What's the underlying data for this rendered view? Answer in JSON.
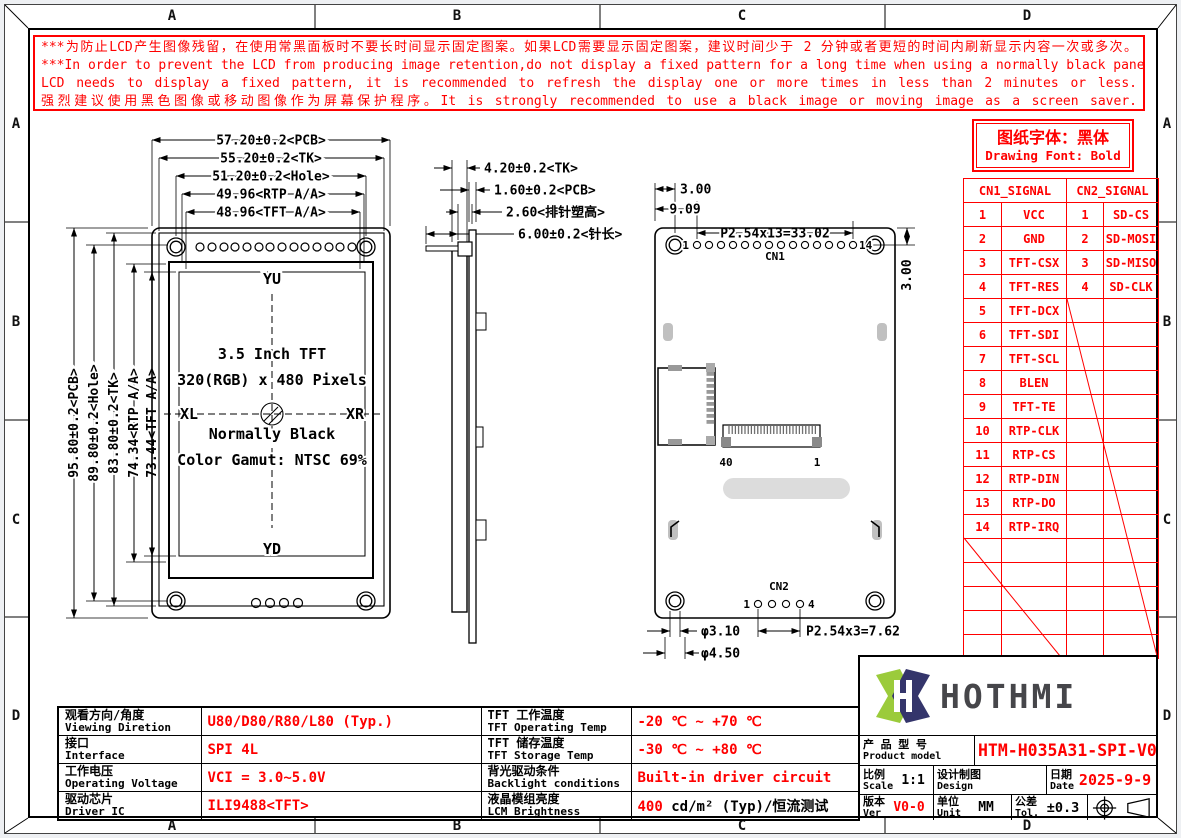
{
  "frame": {
    "cols": [
      "A",
      "B",
      "C",
      "D"
    ],
    "rows": [
      "A",
      "B",
      "C",
      "D"
    ]
  },
  "colors": {
    "red": "#FF0000",
    "line": "#000000",
    "logo_green": "#9BCB3B",
    "logo_navy": "#34356B"
  },
  "warning": {
    "lines": [
      "***为防止LCD产生图像残留，在使用常黑面板时不要长时间显示固定图案。如果LCD需要显示固定图案，建议时间少于 2 分钟或者更短的时间内刷新显示内容一次或多次。",
      "***In order to prevent the LCD from producing image retention,do not display a fixed pattern for a long time when using a normally black panel.If the",
      "LCD needs to display a fixed pattern,  it is recommended to refresh the display one or more times in less than 2 minutes or less.",
      "强烈建议使用黑色图像或移动图像作为屏幕保护程序。It is strongly recommended to use a black image or moving image as a screen saver."
    ]
  },
  "font_note": {
    "cn": "图纸字体：黑体",
    "en": "Drawing Font: Bold"
  },
  "signal_table": {
    "h1": "CN1_SIGNAL",
    "h2": "CN2_SIGNAL",
    "rows": [
      {
        "p1": "1",
        "s1": "VCC",
        "p2": "1",
        "s2": "SD-CS"
      },
      {
        "p1": "2",
        "s1": "GND",
        "p2": "2",
        "s2": "SD-MOSI"
      },
      {
        "p1": "3",
        "s1": "TFT-CSX",
        "p2": "3",
        "s2": "SD-MISO"
      },
      {
        "p1": "4",
        "s1": "TFT-RES",
        "p2": "4",
        "s2": "SD-CLK"
      },
      {
        "p1": "5",
        "s1": "TFT-DCX",
        "p2": "",
        "s2": ""
      },
      {
        "p1": "6",
        "s1": "TFT-SDI",
        "p2": "",
        "s2": ""
      },
      {
        "p1": "7",
        "s1": "TFT-SCL",
        "p2": "",
        "s2": ""
      },
      {
        "p1": "8",
        "s1": "BLEN",
        "p2": "",
        "s2": ""
      },
      {
        "p1": "9",
        "s1": "TFT-TE",
        "p2": "",
        "s2": ""
      },
      {
        "p1": "10",
        "s1": "RTP-CLK",
        "p2": "",
        "s2": ""
      },
      {
        "p1": "11",
        "s1": "RTP-CS",
        "p2": "",
        "s2": ""
      },
      {
        "p1": "12",
        "s1": "RTP-DIN",
        "p2": "",
        "s2": ""
      },
      {
        "p1": "13",
        "s1": "RTP-DO",
        "p2": "",
        "s2": ""
      },
      {
        "p1": "14",
        "s1": "RTP-IRQ",
        "p2": "",
        "s2": ""
      }
    ]
  },
  "specs": {
    "rows": [
      {
        "l1cn": "观看方向/角度",
        "l1en": "Viewing Diretion",
        "v1": "U80/D80/R80/L80 (Typ.)",
        "l2cn": "TFT 工作温度",
        "l2en": "TFT Operating Temp",
        "v2red": "-20 ℃ ~ +70 ℃",
        "v2black": ""
      },
      {
        "l1cn": "接口",
        "l1en": "Interface",
        "v1": "SPI 4L",
        "l2cn": "TFT 储存温度",
        "l2en": "TFT Storage Temp",
        "v2red": "-30 ℃ ~ +80 ℃",
        "v2black": ""
      },
      {
        "l1cn": "工作电压",
        "l1en": "Operating Voltage",
        "v1": "VCI = 3.0~5.0V",
        "l2cn": "背光驱动条件",
        "l2en": "Backlight conditions",
        "v2red": "Built-in driver circuit",
        "v2black": ""
      },
      {
        "l1cn": "驱动芯片",
        "l1en": "Driver IC",
        "v1": "ILI9488<TFT>",
        "l2cn": "液晶模组亮度",
        "l2en": "LCM Brightness",
        "v2red": "400",
        "v2black": " cd/m² (Typ)/恒流测试"
      }
    ]
  },
  "title_block": {
    "logo_text": "HOTHMI",
    "product_cn": "产 品 型 号",
    "product_en": "Product model",
    "product_model": "HTM-H035A31-SPI-V04",
    "scale_cn": "比例",
    "scale_en": "Scale",
    "scale_val": "1:1",
    "design_cn": "设计制图",
    "design_en": "Design",
    "date_cn": "日期",
    "date_en": "Date",
    "date_val": "2025-9-9",
    "ver_cn": "版本",
    "ver_en": "Ver",
    "ver_val": "V0-0",
    "unit_cn": "单位",
    "unit_en": "Unit",
    "unit_val": "MM",
    "tol_cn": "公差",
    "tol_en": "Tol.",
    "tol_val": "±0.3"
  },
  "fv": {
    "h_dims": [
      "57.20±0.2<PCB>",
      "55.20±0.2<TK>",
      "51.20±0.2<Hole>",
      "49.96<RTP A/A>",
      "48.96<TFT A/A>"
    ],
    "v_dims": [
      "95.80±0.2<PCB>",
      "89.80±0.2<Hole>",
      "83.80±0.2<TK>",
      "74.34<RTP A/A>",
      "73.44<TFT A/A>"
    ],
    "yu": "YU",
    "yd": "YD",
    "xl": "XL",
    "xr": "XR",
    "info": [
      "3.5 Inch TFT",
      "320(RGB) x 480 Pixels",
      "Normally Black",
      "Color Gamut: NTSC 69%"
    ]
  },
  "sv": {
    "dims": [
      "4.20±0.2<TK>",
      "1.60±0.2<PCB>",
      "2.60<排针塑高>",
      "6.00±0.2<针长>"
    ]
  },
  "bv": {
    "dim_edge": "3.00",
    "dim_909": "9.09",
    "pitch_cn1": "P2.54x13=33.02",
    "dim_side": "3.00",
    "cn1": "CN1",
    "cn2": "CN2",
    "p1": "1",
    "p14": "14",
    "p40": "40",
    "pf1": "1",
    "c1": "1",
    "c4": "4",
    "d310": "φ3.10",
    "d450": "φ4.50",
    "pitch_cn2": "P2.54x3=7.62"
  }
}
